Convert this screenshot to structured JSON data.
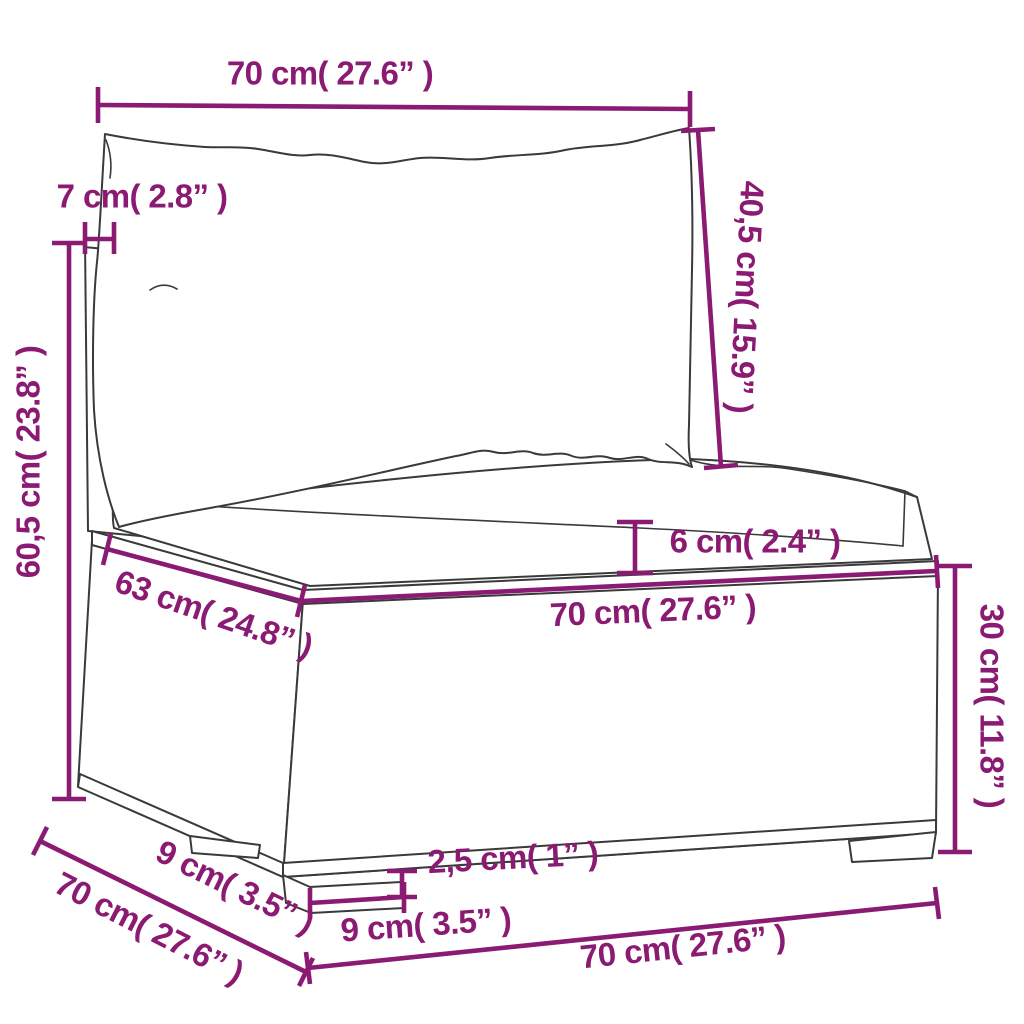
{
  "page": {
    "background_color": "#FFFFFF",
    "accent_color": "#8B1A72",
    "line_art_color": "#3A3A3A"
  },
  "diagram": {
    "subject": "rattan-sofa-section-dimension-drawing",
    "dims": {
      "top_width": "70 cm( 27.6” )",
      "back_cushion_height": "40,5 cm( 15.9” )",
      "back_post_depth": "7 cm( 2.8” )",
      "total_height": "60,5 cm( 23.8” )",
      "seat_edge_depth": "63 cm( 24.8” )",
      "seat_front_width": "70 cm( 27.6” )",
      "cushion_thickness": "6 cm( 2.4” )",
      "base_height": "30 cm( 11.8” )",
      "foot_height": "2,5 cm( 1” )",
      "foot_width": "9 cm( 3.5” )",
      "base_bottom_width": "70 cm( 27.6” )",
      "foot_depth": "9 cm( 3.5” )",
      "total_depth": "70 cm( 27.6” )"
    }
  }
}
